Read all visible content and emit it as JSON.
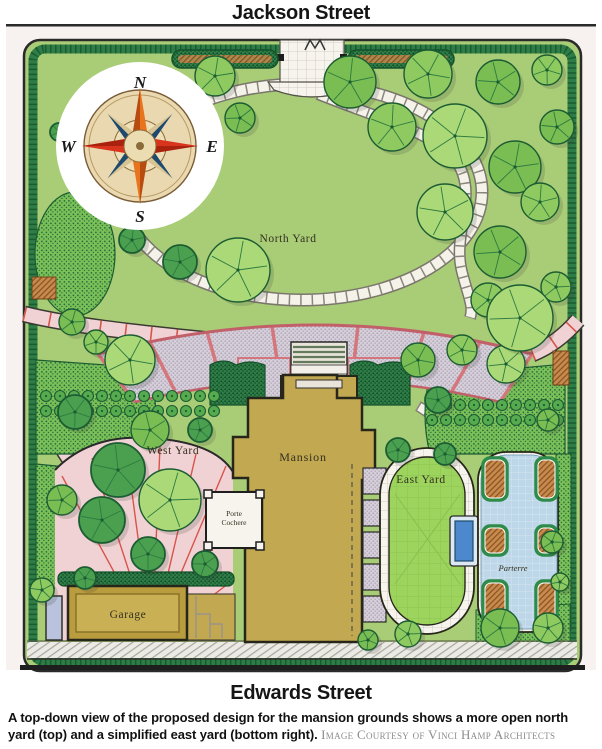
{
  "streets": {
    "top": "Jackson Street",
    "bottom": "Edwards Street"
  },
  "plan": {
    "labels": {
      "north_yard": "North Yard",
      "west_yard": "West Yard",
      "east_yard": "East Yard",
      "mansion": "Mansion",
      "porte_cochere_line1": "Porte",
      "porte_cochere_line2": "Cochere",
      "garage": "Garage",
      "parterre": "Parterre"
    },
    "compass": {
      "north": "N",
      "east": "E",
      "south": "S",
      "west": "W"
    },
    "palette": {
      "lawn_green": "#a9cd76",
      "east_yard_lawn": "#9cd45e",
      "path_pink": "#f0d2d4",
      "joint_red": "#d8544a",
      "terrace_gray": "#d6cfda",
      "building_tan": "#c2a851",
      "hedge_dark_green": "#2e7d46",
      "paving_white": "#f6f4ed",
      "parterre_path_blue": "#bdd7e8",
      "pool_blue": "#4d88cc",
      "compass_orange": "#e8751e",
      "compass_red": "#d8341e",
      "compass_navy": "#1d4a6e"
    }
  },
  "caption": {
    "body": "A top-down view of the proposed design for the mansion grounds shows a more open north yard (top) and a simplified east yard (bottom right).",
    "credit": "Image Courtesy of Vinci Hamp Architects"
  }
}
